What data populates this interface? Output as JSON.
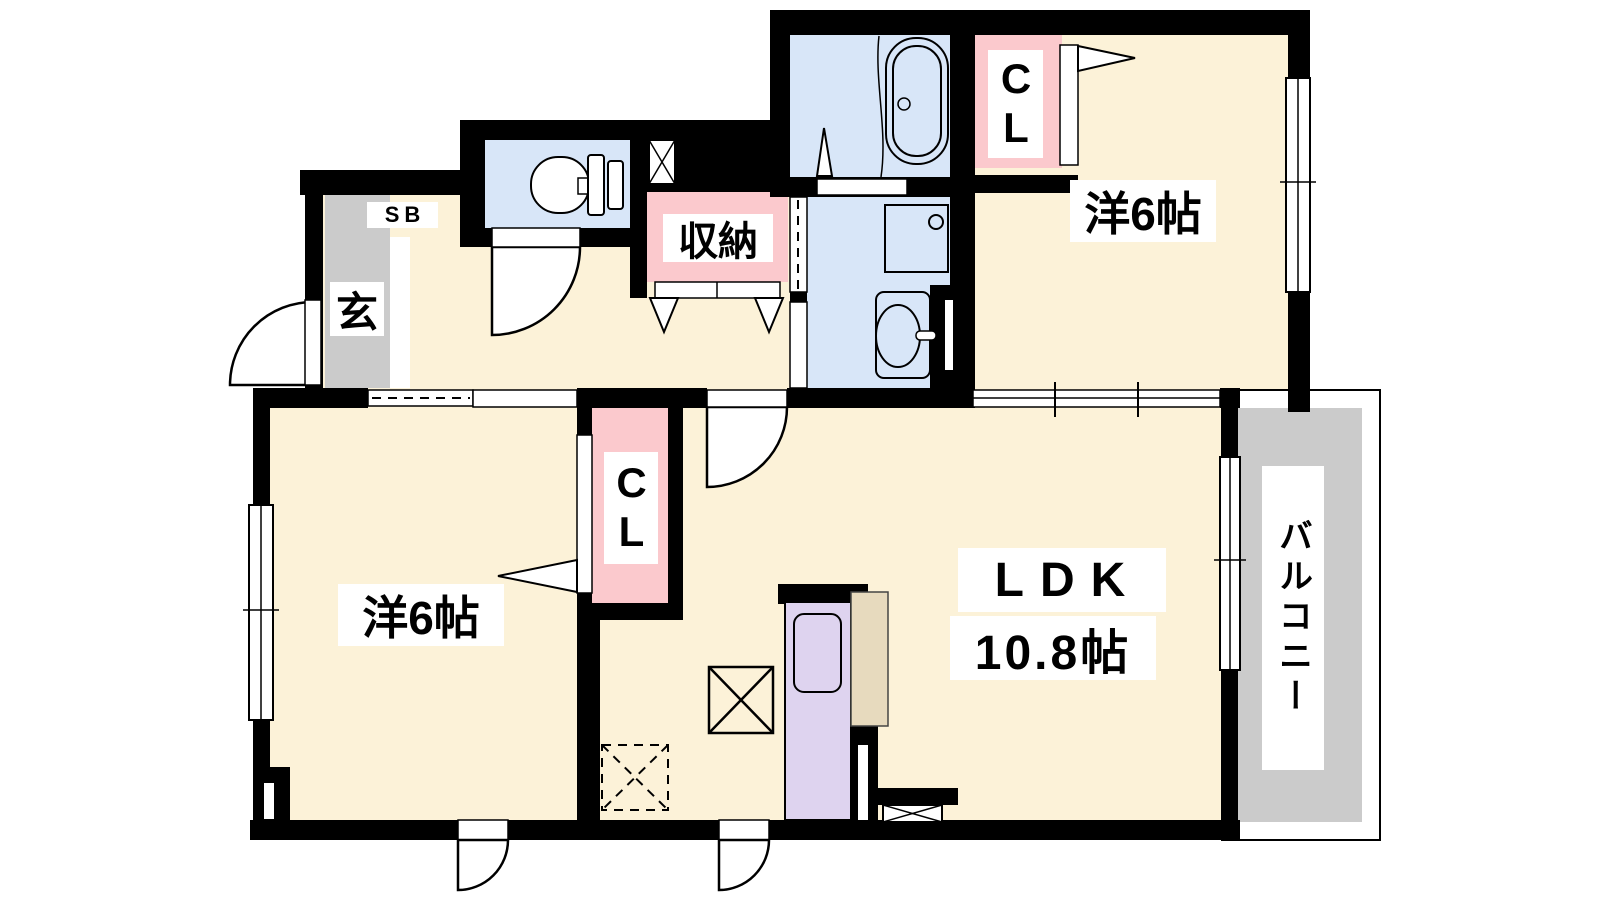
{
  "title": "floor-plan",
  "labels": {
    "bedroom_top": "洋6帖",
    "bedroom_left": "洋6帖",
    "ldk": "LDK",
    "ldk_size": "10.8帖",
    "balcony": "バルコニー",
    "storage": "収納",
    "closet_top": "CL",
    "closet_mid": "CL",
    "shoe_box": "SB",
    "entrance": "玄"
  },
  "colors": {
    "floor": "#fcf2d8",
    "wet": "#d8e6f8",
    "pink": "#fbc9cd",
    "gray": "#cbcbcb",
    "purple": "#ded3ef",
    "tan": "#e7dabe",
    "wall": "#000000",
    "white": "#ffffff"
  },
  "fixtures": [
    "bathtub",
    "toilet",
    "washbasin",
    "washing-machine-pan",
    "kitchen-sink",
    "refrigerator-space",
    "shaft",
    "range-hood-box",
    "ceiling-storage-box"
  ]
}
